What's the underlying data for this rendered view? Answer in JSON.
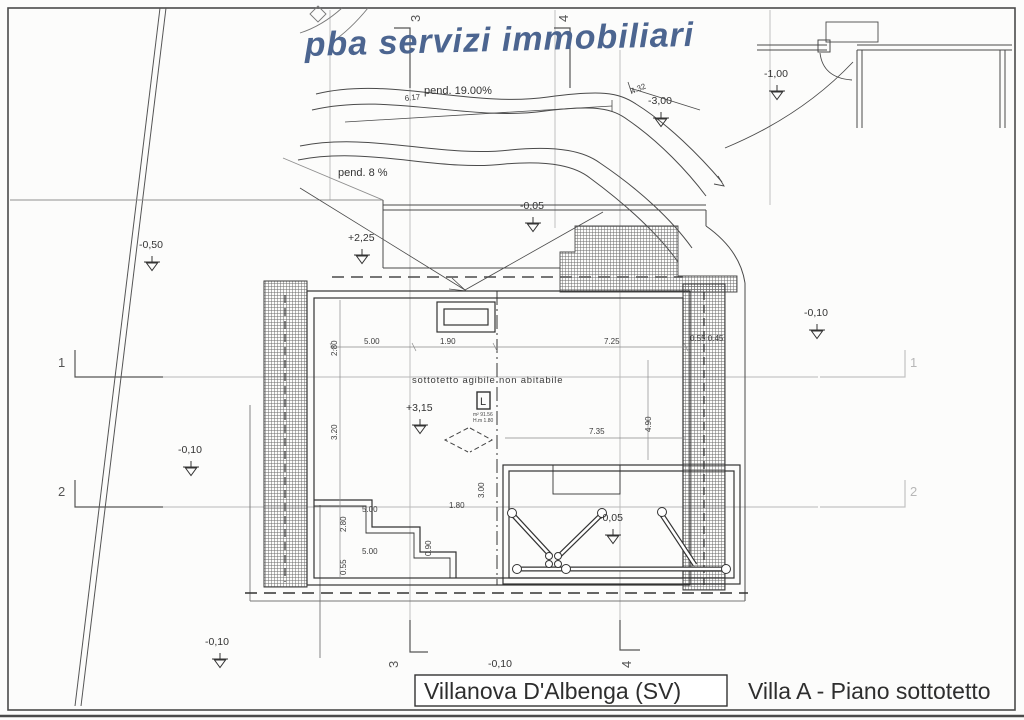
{
  "watermark": "pba servizi immobiliari",
  "title_block": {
    "location": "Villanova D'Albenga (SV)",
    "drawing_title": "Villa A - Piano sottotetto"
  },
  "slopes": {
    "upper": "pend. 19.00%",
    "lower": "pend. 8 %",
    "dim_a": "6.17",
    "dim_b": "4.32"
  },
  "room": {
    "label": "sottotetto agibile non abitabile",
    "symbol": "L",
    "area": "m² 91.56",
    "height": "H.m 1.80"
  },
  "levels": {
    "minus_050": "-0,50",
    "plus_225": "+2,25",
    "minus_005_top": "-0,05",
    "minus_300": "-3,00",
    "minus_100": "-1,00",
    "minus_010_right": "-0,10",
    "plus_315": "+3,15",
    "minus_005_mid": "-0,05",
    "minus_010_left": "-0,10",
    "minus_010_bottom_left": "-0,10",
    "minus_010_bottom_center": "-0,10"
  },
  "dims": {
    "top_1": "5.00",
    "top_2": "1.90",
    "top_3": "7.25",
    "left_1": "2.80",
    "left_2": "3.20",
    "left_3": "2.80",
    "left_4": "0.55",
    "right_1": "0.55 0.45",
    "right_2": "4.90",
    "mid_1": "7.35",
    "mid_2": "3.00",
    "mid_3": "1.80",
    "mid_4": "0.90",
    "bottom_1": "5.00",
    "bottom_2": "5.00"
  },
  "sections": {
    "s1": "1",
    "s2": "2",
    "s3": "3",
    "s4": "4"
  }
}
